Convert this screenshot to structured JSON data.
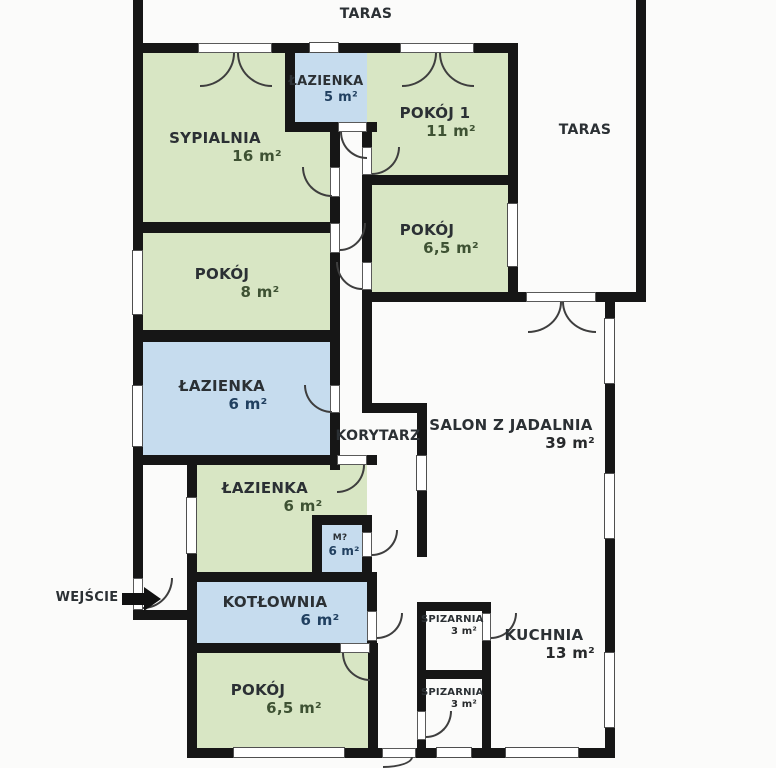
{
  "rooms": {
    "sypialnia": {
      "name": "SYPIALNIA",
      "area": "16 m²"
    },
    "lazienka_gora": {
      "name": "ŁAZIENKA",
      "area": "5 m²"
    },
    "pokoj_1": {
      "name": "POKÓJ 1",
      "area": "11 m²"
    },
    "pokoj_65_gora": {
      "name": "POKÓJ",
      "area": "6,5 m²"
    },
    "pokoj_8": {
      "name": "POKÓJ",
      "area": "8 m²"
    },
    "lazienka_niebieska": {
      "name": "ŁAZIENKA",
      "area": "6 m²"
    },
    "lazienka_zielona": {
      "name": "ŁAZIENKA",
      "area": "6 m²"
    },
    "m_pokoik": {
      "name": "M?",
      "area": "6 m²"
    },
    "kotlownia": {
      "name": "KOTŁOWNIA",
      "area": "6 m²"
    },
    "pokoj_65_dol": {
      "name": "POKÓJ",
      "area": "6,5 m²"
    },
    "korytarz": {
      "name": "KORYTARZ"
    },
    "salon": {
      "name": "SALON Z JADALNIA",
      "area": "39 m²"
    },
    "spizarnia_1": {
      "name": "SPIZARNIA",
      "area": "3 m²"
    },
    "spizarnia_2": {
      "name": "SPIZARNIA",
      "area": "3 m²"
    },
    "kuchnia": {
      "name": "KUCHNIA",
      "area": "13 m²"
    },
    "taras_gora": {
      "name": "TARAS"
    },
    "taras_prawy": {
      "name": "TARAS"
    },
    "wejscie": {
      "name": "WEJŚCIE"
    }
  },
  "colors": {
    "room_green": "#d8e6c4",
    "room_blue": "#c6dcee",
    "wall": "#161616",
    "label_text": "#2b3034"
  }
}
